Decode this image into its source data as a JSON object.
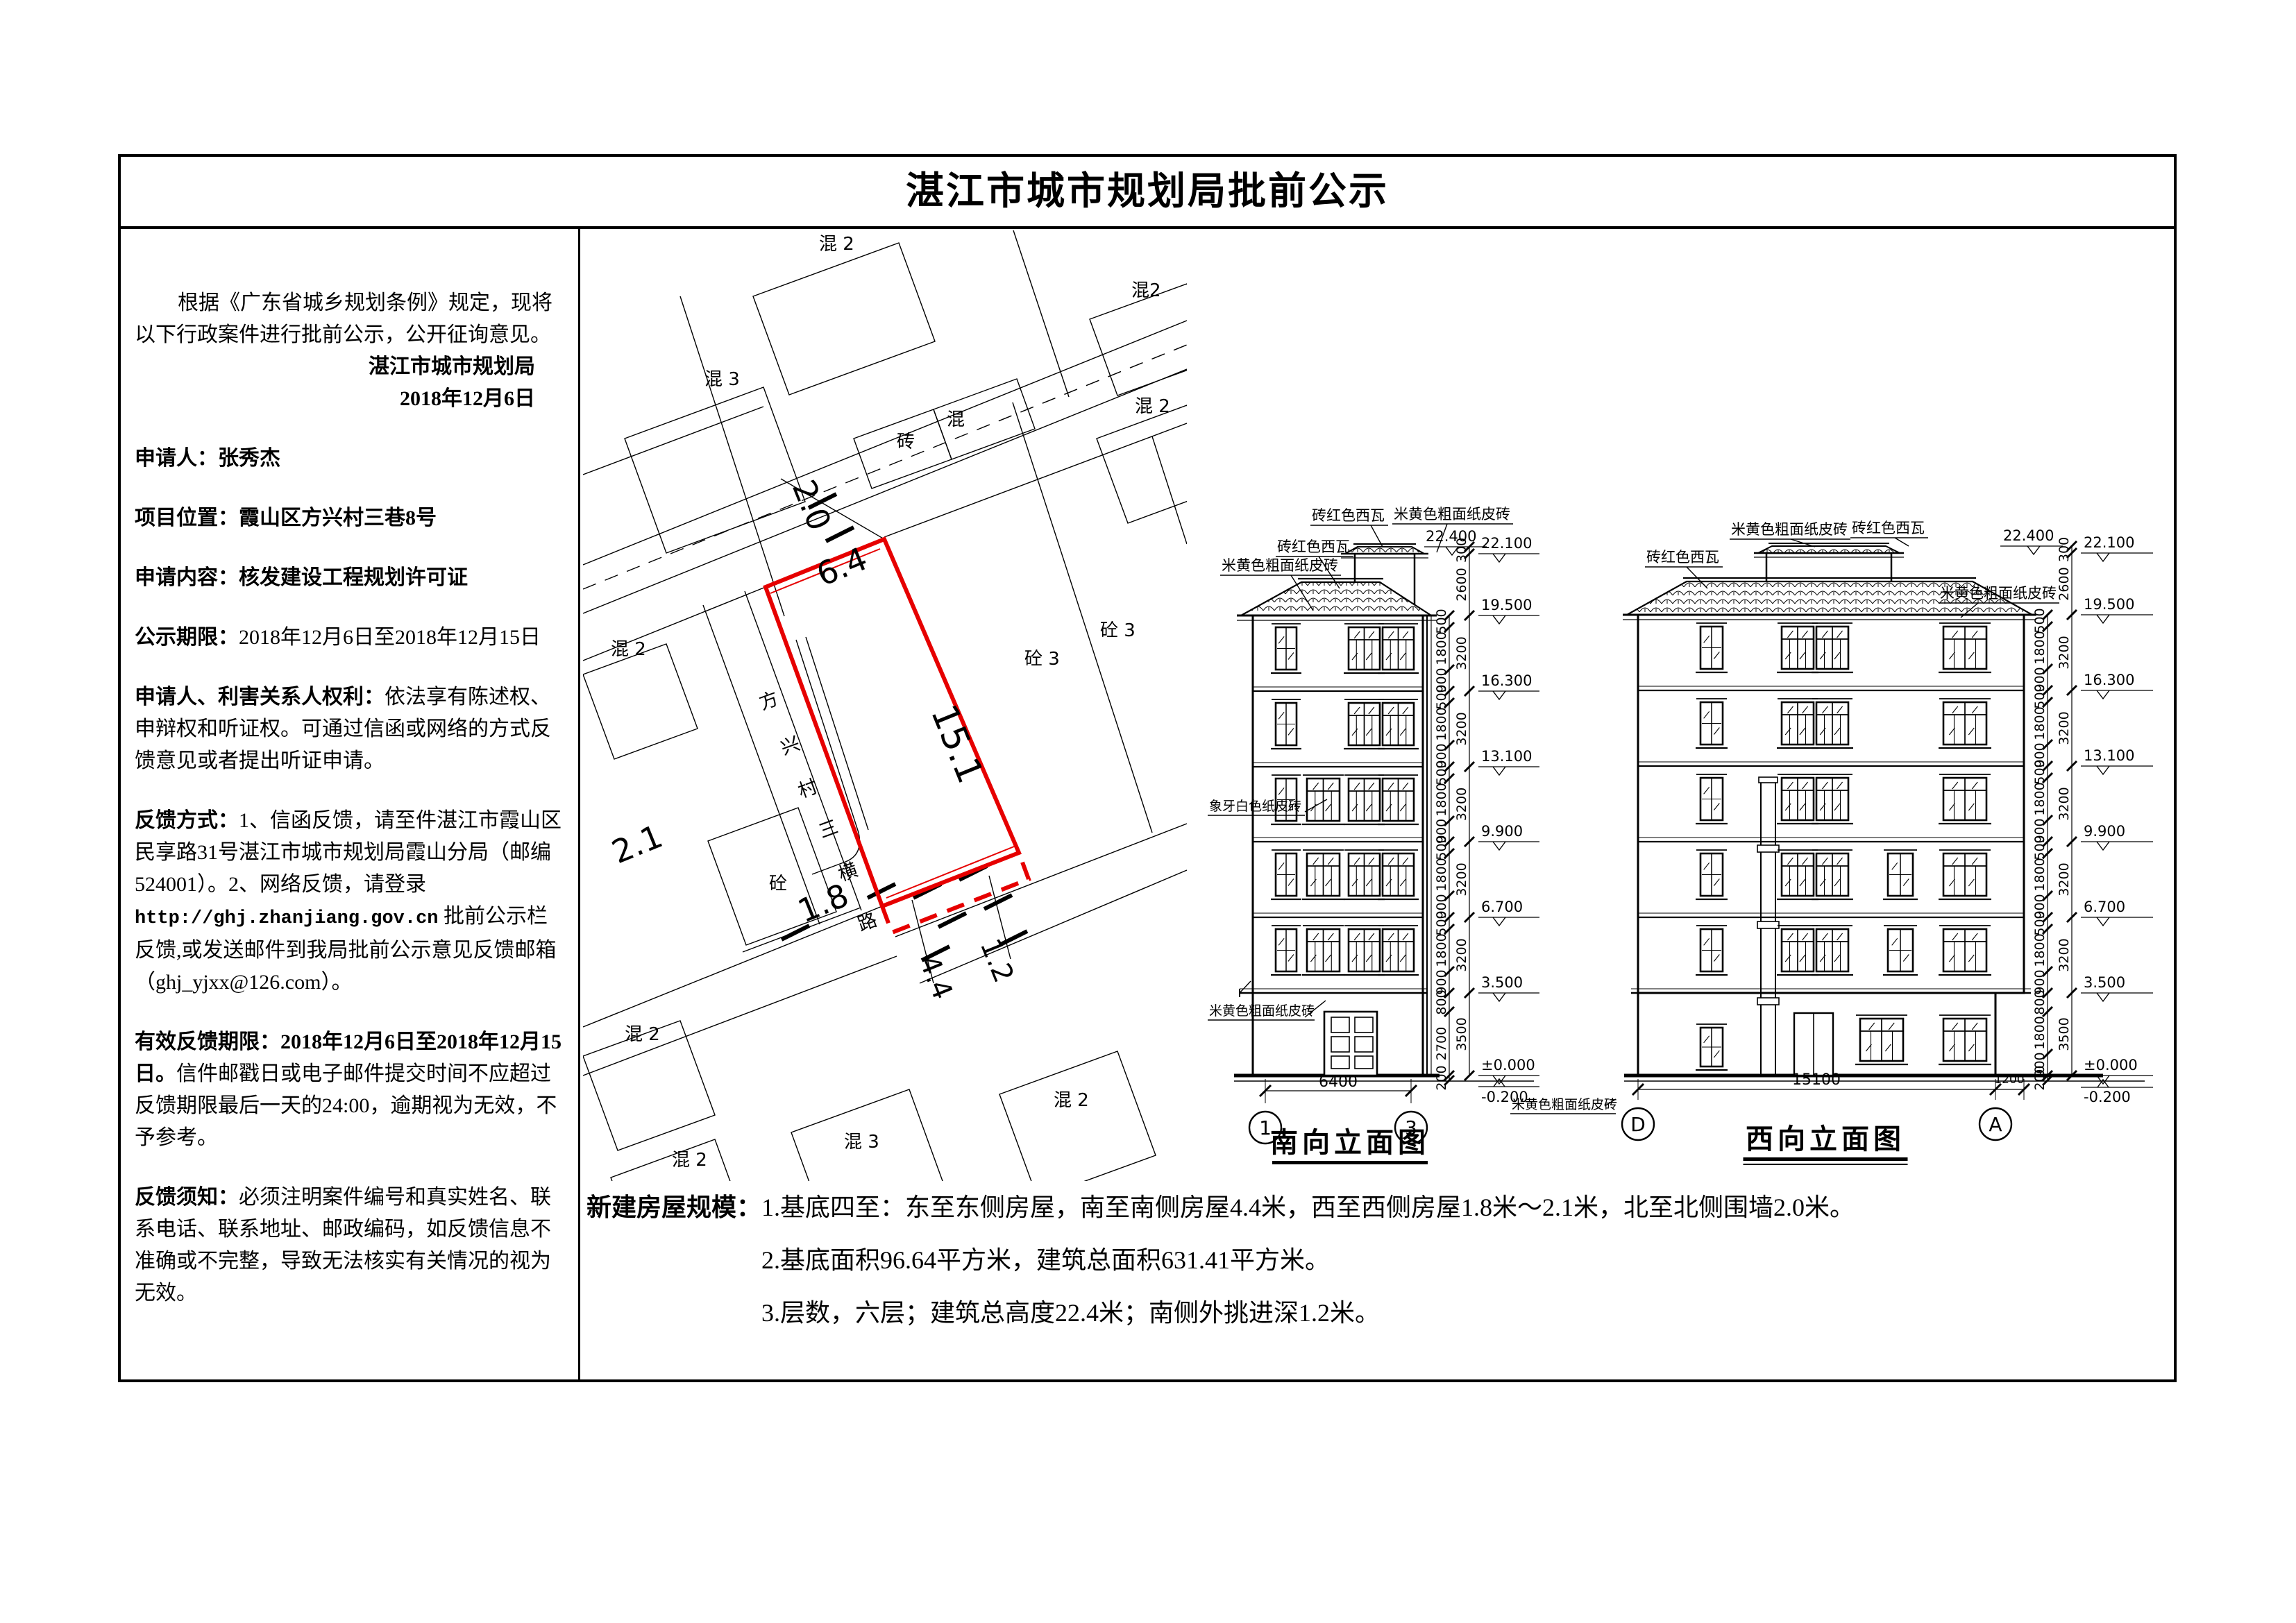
{
  "page": {
    "title": "湛江市城市规划局批前公示"
  },
  "notice": {
    "intro": "根据《广东省城乡规划条例》规定，现将以下行政案件进行批前公示，公开征询意见。",
    "authority": "湛江市城市规划局",
    "date": "2018年12月6日",
    "applicant_label": "申请人：",
    "applicant_value": "张秀杰",
    "location_label": "项目位置：",
    "location_value": "霞山区方兴村三巷8号",
    "content_label": "申请内容：",
    "content_value": "核发建设工程规划许可证",
    "period_label": "公示期限：",
    "period_value": "2018年12月6日至2018年12月15日",
    "rights_label": "申请人、利害关系人权利：",
    "rights_value": "依法享有陈述权、申辩权和听证权。可通过信函或网络的方式反馈意见或者提出听证申请。",
    "feedback_label": "反馈方式：",
    "feedback_pre": "1、信函反馈，请至件湛江市霞山区民享路31号湛江市城市规划局霞山分局（邮编524001）。2、网络反馈，请登录",
    "feedback_url": "http://ghj.zhanjiang.gov.cn",
    "feedback_post": " 批前公示栏反馈,或发送邮件到我局批前公示意见反馈邮箱（ghj_yjxx@126.com）。",
    "valid_label": "有效反馈期限：",
    "valid_dates": "2018年12月6日至2018年12月15日。",
    "valid_rest": "信件邮戳日或电子邮件提交时间不应超过反馈期限最后一天的24:00，逾期视为无效，不予参考。",
    "notes_label": "反馈须知：",
    "notes_value": "必须注明案件编号和真实姓名、联系电话、联系地址、邮政编码，如反馈信息不准确或不完整，导致无法核实有关情况的视为无效。"
  },
  "site_plan": {
    "road_name": "方兴村三横路",
    "road_chars": [
      "方",
      "兴",
      "村",
      "三",
      "横",
      "路"
    ],
    "parcel_dims": {
      "north": "2.0",
      "top_edge": "6.4",
      "long_side": "15.1",
      "west_a": "2.1",
      "west_b": "1.8",
      "south": "4.4",
      "overhang": "1.2"
    },
    "labels": [
      "混 2",
      "混 3",
      "混2",
      "混 2",
      "砖",
      "混",
      "砼 3",
      "砼 3",
      "砼",
      "混 2",
      "混 2",
      "混 3",
      "混 2",
      "混 2"
    ],
    "red_color": "#e60000"
  },
  "elevations": {
    "levels": [
      "22.400",
      "22.100",
      "19.500",
      "16.300",
      "13.100",
      "9.900",
      "6.700",
      "3.500",
      "±0.000",
      "-0.200"
    ],
    "materials": {
      "tile": "砖红色西瓦",
      "brick": "米黄色粗面纸皮砖",
      "ivory": "象牙白色纸皮砖"
    },
    "south": {
      "title": "南向立面图",
      "width_dim": "6400",
      "axis_left": "1",
      "axis_right": "3",
      "chain_inner": [
        "500",
        "1800",
        "900",
        "500",
        "1800",
        "900",
        "500",
        "1800",
        "900",
        "500",
        "1800",
        "900",
        "500",
        "1800",
        "900",
        "800",
        "2700",
        "200"
      ],
      "chain_outer": [
        "300",
        "2600",
        "3200",
        "3200",
        "3200",
        "3200",
        "3200",
        "3500"
      ]
    },
    "west": {
      "title": "西向立面图",
      "width_dim": "15100",
      "overhang_dim": "1200",
      "axis_left": "D",
      "axis_right": "A",
      "chain_inner": [
        "500",
        "1800",
        "900",
        "500",
        "1800",
        "900",
        "500",
        "1800",
        "900",
        "500",
        "1800",
        "900",
        "500",
        "1800",
        "900",
        "800",
        "1800",
        "900",
        "200"
      ],
      "chain_outer": [
        "300",
        "2600",
        "3200",
        "3200",
        "3200",
        "3200",
        "3200",
        "3500"
      ]
    }
  },
  "building_scale": {
    "label": "新建房屋规模：",
    "item1": "1.基底四至：东至东侧房屋，南至南侧房屋4.4米，西至西侧房屋1.8米～2.1米，北至北侧围墙2.0米。",
    "item2": "2.基底面积96.64平方米，建筑总面积631.41平方米。",
    "item3": "3.层数，六层；建筑总高度22.4米；南侧外挑进深1.2米。"
  }
}
